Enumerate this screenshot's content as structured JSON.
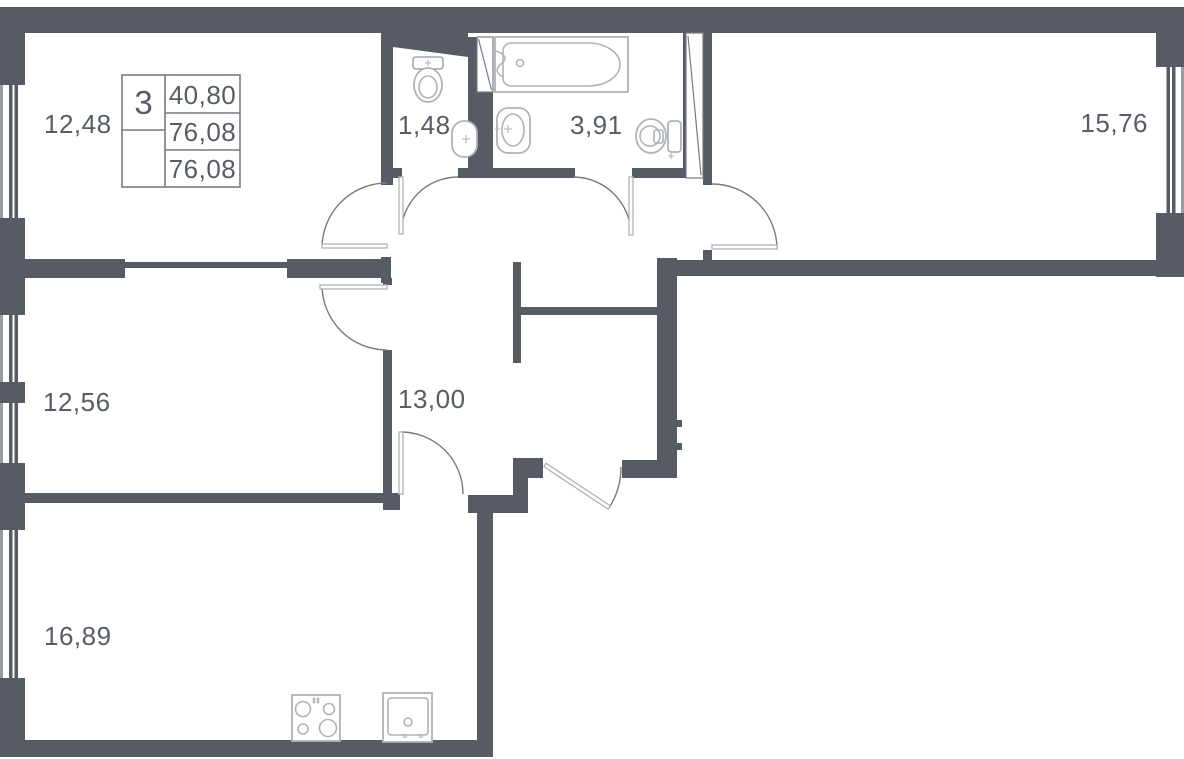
{
  "title": "apartment-floor-plan",
  "legend": {
    "rooms_count": "3",
    "living_area": "40,80",
    "total_area": "76,08",
    "declared_area": "76,08"
  },
  "areas": {
    "bedroom_top_left": "12,48",
    "wc": "1,48",
    "bathroom": "3,91",
    "bedroom_top_right": "15,76",
    "bedroom_mid_left": "12,56",
    "hallway": "13,00",
    "kitchen_living": "16,89"
  },
  "colors": {
    "wall": "#565b64",
    "line": "#767b83",
    "fixture": "#aeb3ba",
    "text": "#575c66",
    "bg": "#ffffff"
  }
}
